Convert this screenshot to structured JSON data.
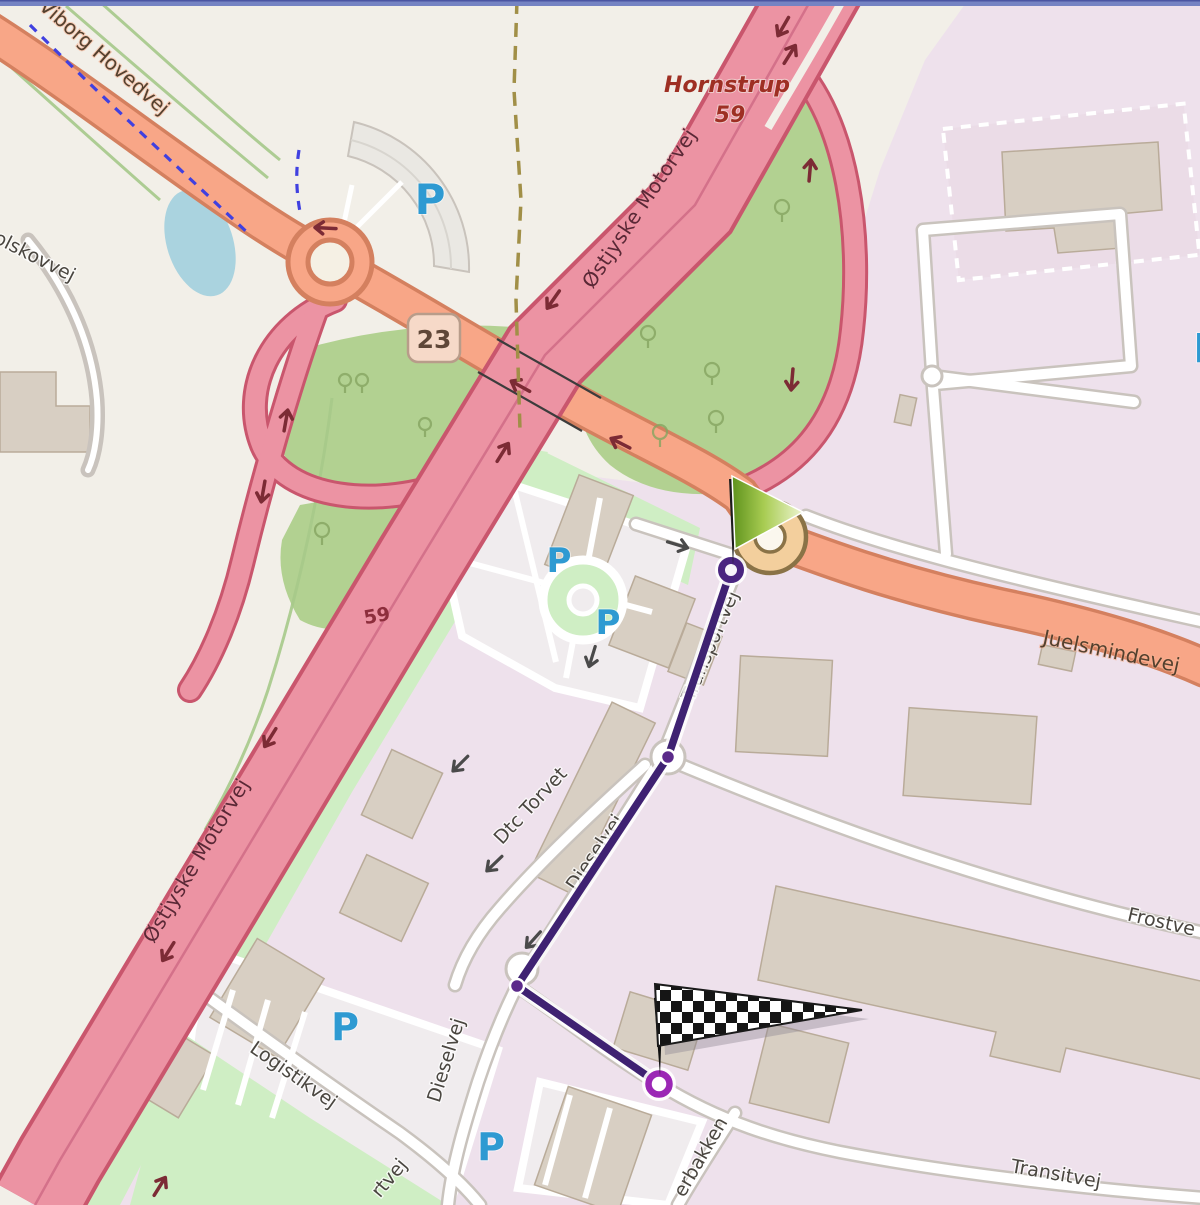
{
  "map": {
    "type": "openstreetmap-route-view",
    "labels": {
      "viborg_hovedvej": "Viborg Hovedvej",
      "olskovvej": "olskovvej",
      "hornstrup": "Hornstrup",
      "hornstrup_ref": "59",
      "ostjyske_motorvej": "Østjyske Motorvej",
      "motorway_ref": "59",
      "exit_ref": "23",
      "juelsmindevej": "Juelsmindevej",
      "transportvej": "Transportvej",
      "dieselvej": "Dieselvej",
      "dtc_torvet": "Dtc Torvet",
      "logistikvej": "Logistikvej",
      "frostvej_partial": "Frostve",
      "transitvej": "Transitvej",
      "erbakken_partial": "erbakken",
      "rtvej_partial": "rtvej",
      "parking": "P"
    },
    "icons": {
      "route_start": "green-flag",
      "route_finish": "checkered-flag",
      "parking_symbol": "blue-letter-P",
      "tree": "circle-with-stem"
    },
    "colors": {
      "background": "#f2efe8",
      "industrial_area": "#eee1ec",
      "grass": "#cfeec4",
      "interchange_green": "#b2d191",
      "water": "#aad3df",
      "motorway_fill": "#ec93a3",
      "motorway_casing": "#c9566d",
      "trunk_fill": "#f8a687",
      "trunk_casing": "#d4805f",
      "roundabout_tan": "#f3cf9d",
      "route_line": "#3f2272",
      "route_end_ring": "#9b27b5",
      "parking_blue": "#2e9ad2",
      "place_label": "#9e2f23",
      "boundary_dash": "#a18f47",
      "cycle_route_dash": "#4040e0"
    }
  }
}
